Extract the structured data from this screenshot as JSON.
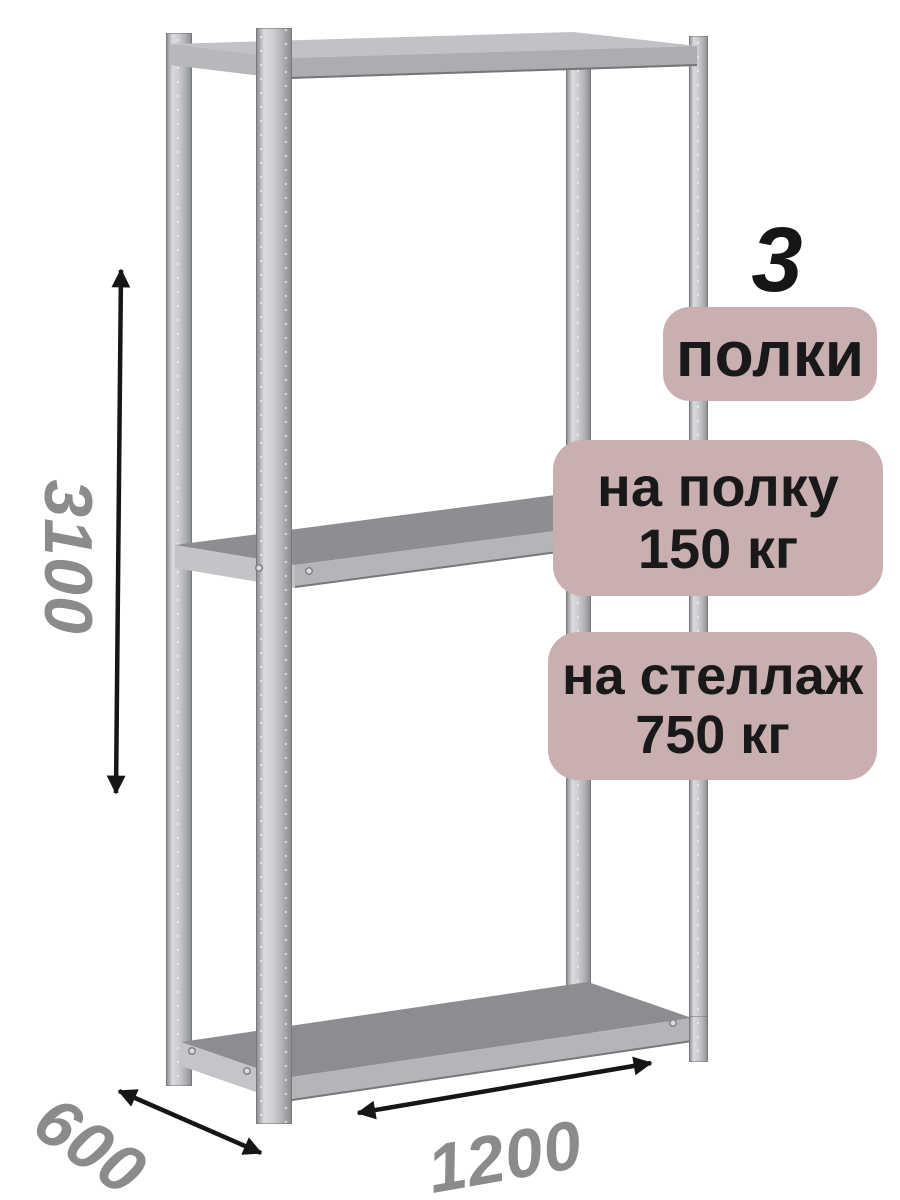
{
  "figure": {
    "shelf_count": "3",
    "shelf_count_badge": "полки",
    "capacity_badges": [
      {
        "line1": "на полку",
        "line2": "150 кг"
      },
      {
        "line1": "на стеллаж",
        "line2": "750 кг"
      }
    ],
    "dimensions": {
      "height_mm": "3100",
      "depth_mm": "600",
      "width_mm": "1200"
    }
  },
  "colors": {
    "badge-bg": "#c9afaf",
    "badge-text": "#191919",
    "dimension-text": "#8b8b8b",
    "arrow": "#161616"
  }
}
